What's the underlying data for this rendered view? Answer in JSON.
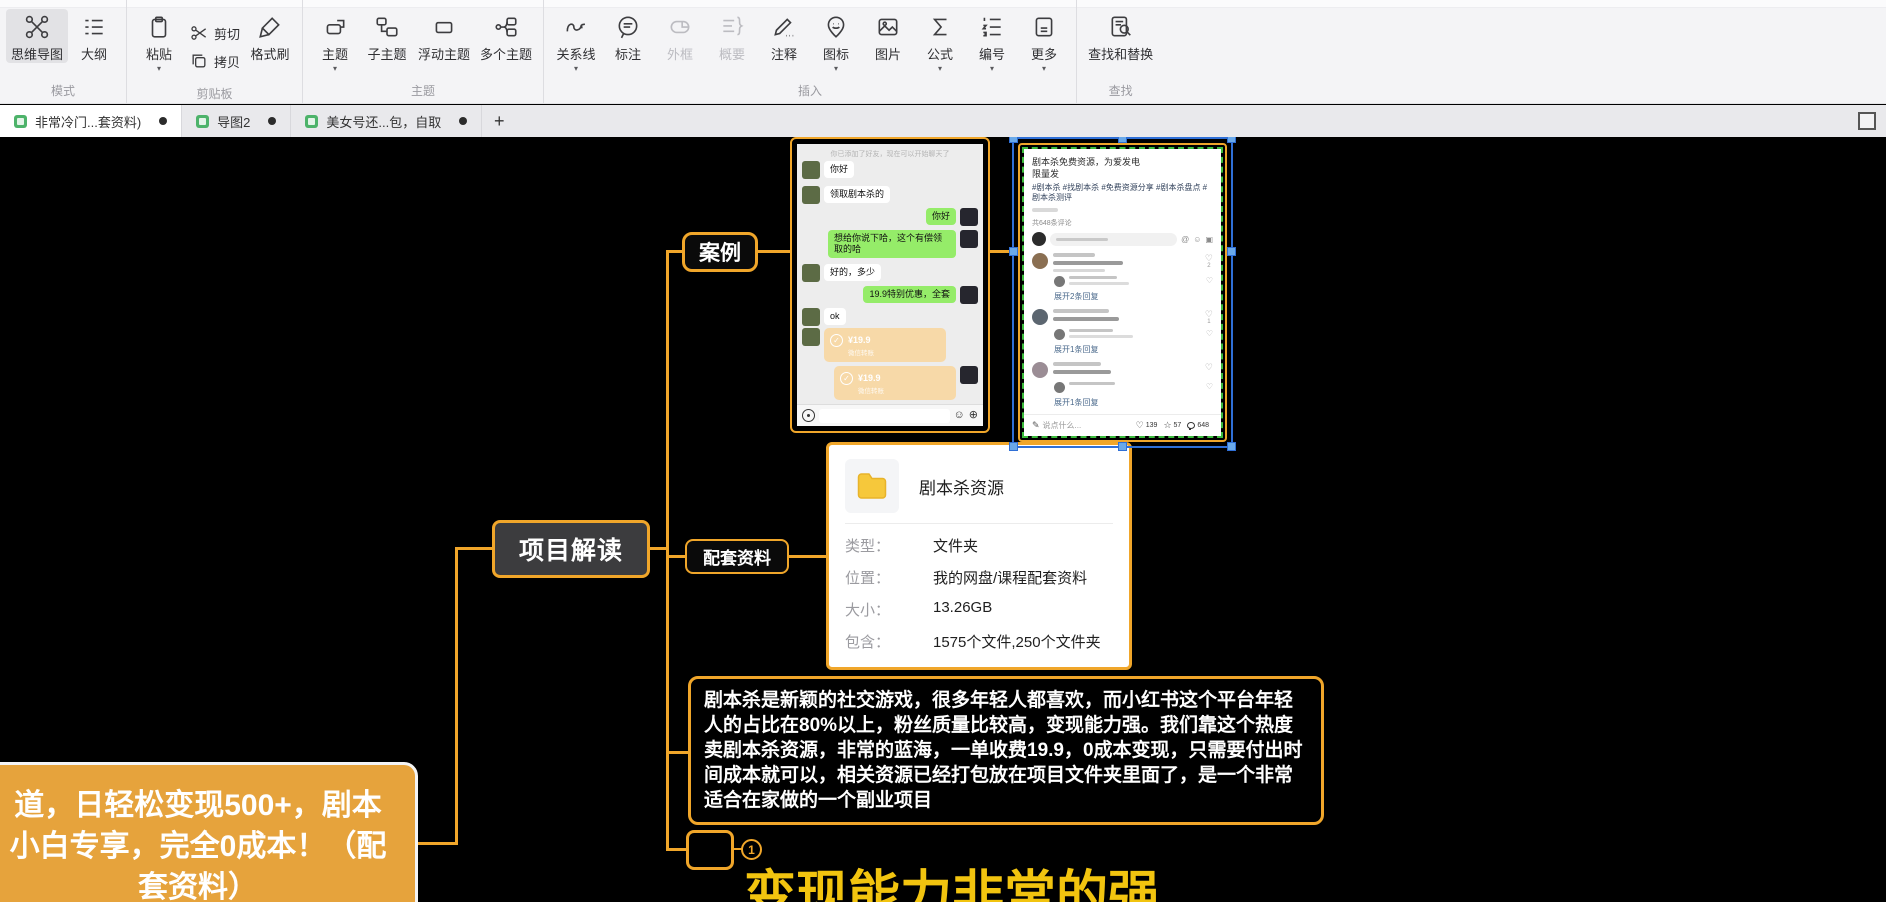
{
  "toolbar": {
    "groups": [
      {
        "label": "模式",
        "buttons": [
          {
            "label": "思维导图"
          },
          {
            "label": "大纲"
          }
        ]
      },
      {
        "label": "剪贴板",
        "buttons": [
          {
            "label": "粘贴"
          },
          {
            "label": "剪切"
          },
          {
            "label": "拷贝"
          },
          {
            "label": "格式刷"
          }
        ]
      },
      {
        "label": "主题",
        "buttons": [
          {
            "label": "主题"
          },
          {
            "label": "子主题"
          },
          {
            "label": "浮动主题"
          },
          {
            "label": "多个主题"
          }
        ]
      },
      {
        "label": "插入",
        "buttons": [
          {
            "label": "关系线"
          },
          {
            "label": "标注"
          },
          {
            "label": "外框"
          },
          {
            "label": "概要"
          },
          {
            "label": "注释"
          },
          {
            "label": "图标"
          },
          {
            "label": "图片"
          },
          {
            "label": "公式"
          },
          {
            "label": "编号"
          },
          {
            "label": "更多"
          }
        ]
      },
      {
        "label": "查找",
        "buttons": [
          {
            "label": "查找和替换"
          }
        ]
      }
    ]
  },
  "tabs": {
    "items": [
      {
        "title": "非常冷门...套资料)"
      },
      {
        "title": "导图2"
      },
      {
        "title": "美女号还...包，自取"
      }
    ],
    "new_tab": "+"
  },
  "mindmap": {
    "root_text": "道，日轻松变现500+，剧本\n小白专享，完全0成本！（配\n套资料）",
    "project_node": "项目解读",
    "case_node": "案例",
    "materials_node": "配套资料",
    "description": "剧本杀是新颖的社交游戏，很多年轻人都喜欢，而小红书这个平台年轻人的占比在80%以上，粉丝质量比较高，变现能力强。我们靠这个热度卖剧本杀资源，非常的蓝海，一单收费19.9，0成本变现，只需要付出时间成本就可以，相关资源已经打包放在项目文件夹里面了，是一个非常适合在家做的一个副业项目",
    "big_text": "变现能力非常的强",
    "badge_number": "1",
    "accent_color": "#f0a62a",
    "big_text_color": "#f2c40f",
    "root_fill_color": "#e6a33c"
  },
  "chat": {
    "system_message": "你已添加了好友，现在可以开始聊天了",
    "messages": [
      {
        "side": "left",
        "text": "你好"
      },
      {
        "side": "left",
        "text": "领取剧本杀的"
      },
      {
        "side": "right",
        "text": "你好"
      },
      {
        "side": "right",
        "text": "想给你说下哈，这个有偿领取的哈"
      },
      {
        "side": "left",
        "text": "好的，多少"
      },
      {
        "side": "right",
        "text": "19.9特别优惠，全套"
      },
      {
        "side": "left",
        "text": "ok"
      }
    ],
    "transfer": {
      "amount": "¥19.9",
      "label": "微信转账"
    }
  },
  "xhs": {
    "title_line1": "剧本杀免费资源，为爱发电",
    "title_line2": "限量发",
    "hashtags": "#剧本杀 #找剧本杀 #免费资源分享 #剧本杀盘点 #剧本杀测评",
    "comments_header": "共648条评论",
    "expand_1": "展开2条回复",
    "expand_2": "展开1条回复",
    "expand_3": "展开1条回复",
    "input_placeholder": "说点什么...",
    "like_count": "139",
    "star_count": "57",
    "comment_count": "648"
  },
  "file_card": {
    "title": "剧本杀资源",
    "rows": [
      {
        "label": "类型：",
        "value": "文件夹"
      },
      {
        "label": "位置：",
        "value": "我的网盘/课程配套资料"
      },
      {
        "label": "大小：",
        "value": "13.26GB"
      },
      {
        "label": "包含：",
        "value": "1575个文件,250个文件夹"
      }
    ]
  }
}
